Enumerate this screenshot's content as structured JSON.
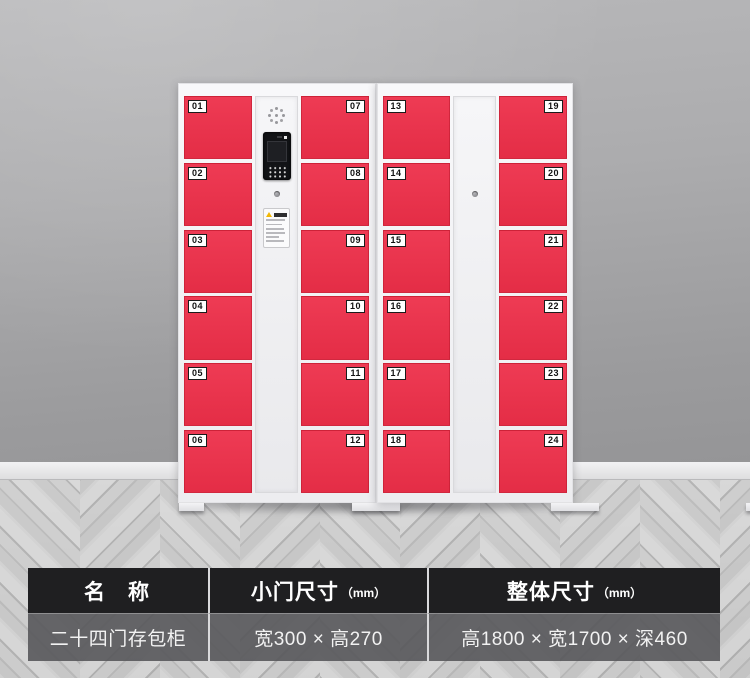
{
  "locker": {
    "doors": [
      "01",
      "02",
      "03",
      "04",
      "05",
      "06",
      "07",
      "08",
      "09",
      "10",
      "11",
      "12",
      "13",
      "14",
      "15",
      "16",
      "17",
      "18",
      "19",
      "20",
      "21",
      "22",
      "23",
      "24"
    ],
    "door_count": 24,
    "colors": {
      "door_red": "#e8324b",
      "cabinet_frame": "#f2f2f4",
      "wall": "#a5a5a7",
      "floor": "#cccccc"
    },
    "icons": {
      "speaker": "speaker-grille-icon",
      "intercom": "intercom-keypad-icon",
      "keyhole": "keyhole-icon",
      "warning": "warning-triangle-icon"
    }
  },
  "spec_table": {
    "colors": {
      "header_bg": "#1f1f21",
      "row_bg": "#58585b",
      "text": "#ffffff"
    },
    "headers": [
      {
        "main": "名　称",
        "unit": ""
      },
      {
        "main": "小门尺寸",
        "unit": "（mm）"
      },
      {
        "main": "整体尺寸",
        "unit": "（mm）"
      }
    ],
    "row": [
      "二十四门存包柜",
      "宽300 × 高270",
      "高1800 × 宽1700 × 深460"
    ]
  }
}
